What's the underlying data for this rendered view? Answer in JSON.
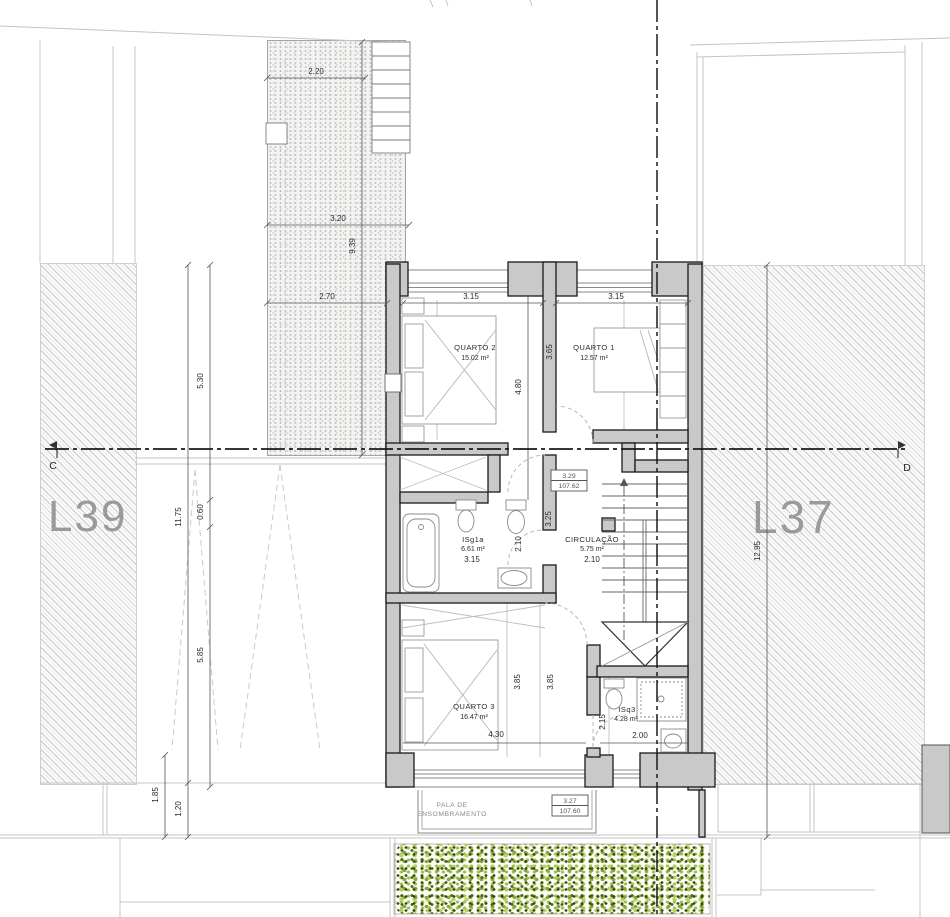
{
  "lots": {
    "left_label": "L39",
    "right_label": "L37"
  },
  "section": {
    "left_marker": "C",
    "right_marker": "D"
  },
  "rooms": {
    "quarto2": {
      "name": "QUARTO 2",
      "area": "15.02 m²"
    },
    "quarto1": {
      "name": "QUARTO 1",
      "area": "12.57 m²"
    },
    "isg1a": {
      "name": "ISg1a",
      "area": "6.61 m²"
    },
    "circulacao": {
      "name": "CIRCULAÇÃO",
      "area": "5.75 m²"
    },
    "quarto3": {
      "name": "QUARTO 3",
      "area": "16.47 m²"
    },
    "isq3": {
      "name": "ISq3",
      "area": "4.28 m²"
    }
  },
  "canopy": {
    "line1": "PALA DE",
    "line2": "ENSOMBRAMENTO"
  },
  "levels": {
    "upper": {
      "height": "3.29",
      "elevation": "107.62"
    },
    "lower": {
      "height": "3.27",
      "elevation": "107.60"
    }
  },
  "dims": {
    "terrace_width_top": "2.20",
    "terrace_width_mid": "3.20",
    "terrace_length": "9.39",
    "terrace_width_low": "2.70",
    "yard_left_upper": "5.30",
    "yard_left_total": "11.75",
    "yard_left_step": "0.60",
    "yard_left_lower": "5.85",
    "yard_bottom_a": "1.85",
    "yard_bottom_b": "1.20",
    "lot_right_depth": "12.95",
    "quarto2_width": "3.15",
    "quarto1_width": "3.15",
    "quarto2_depth": "4.80",
    "quarto1_depth": "3.65",
    "hall_depth": "3.25",
    "isg1a_width": "3.15",
    "isg1a_depth": "2.10",
    "circ_width": "2.10",
    "quarto3_width": "4.30",
    "quarto3_depth_a": "3.85",
    "quarto3_depth_b": "3.85",
    "isq3_depth": "2.15",
    "isq3_width": "2.00"
  }
}
